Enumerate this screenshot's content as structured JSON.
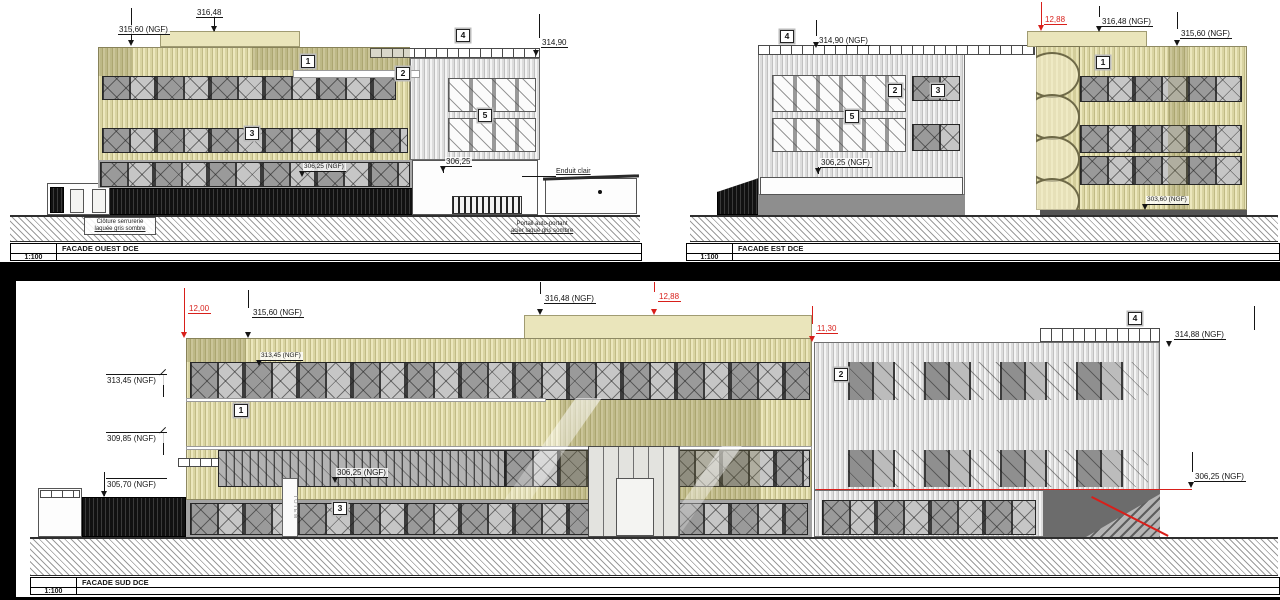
{
  "colors": {
    "accent_red": "#d81f1a",
    "facade_yellow": "#d9d4a2",
    "cladding_gray": "#dcdcdc"
  },
  "west": {
    "title": "FACADE OUEST DCE",
    "scale": "1:100",
    "tags": {
      "t1": "1",
      "t2": "2",
      "t3": "3",
      "t4": "4",
      "t5": "5"
    },
    "labels": {
      "e316_48": "316,48",
      "e315_60": "315,60 (NGF)",
      "e314_90": "314,90",
      "e306_25_ngf": "306,25 (NGF)",
      "e306_25": "306,25",
      "enduit": "Enduit clair",
      "cloture_1": "Clôture serrurerie",
      "cloture_2": "laquée gris sombre",
      "portail_1": "Portail auto-portant",
      "portail_2": "acier laqué gris sombre"
    }
  },
  "est": {
    "title": "FACADE EST DCE",
    "scale": "1:100",
    "tags": {
      "t1": "1",
      "t2": "2",
      "t3": "3",
      "t4": "4",
      "t5": "5"
    },
    "labels": {
      "red_12_88": "12,88",
      "e316_48": "316,48 (NGF)",
      "e315_60": "315,60 (NGF)",
      "e314_90": "314,90 (NGF)",
      "e306_25": "306,25 (NGF)",
      "e303_60": "303,60 (NGF)"
    }
  },
  "sud": {
    "title": "FACADE SUD DCE",
    "scale": "1:100",
    "tags": {
      "t1": "1",
      "t2": "2",
      "t3": "3",
      "t4": "4"
    },
    "labels": {
      "red_12_00": "12,00",
      "red_12_88": "12,88",
      "red_11_30": "11,30",
      "e315_60": "315,60 (NGF)",
      "e316_48": "316,48 (NGF)",
      "e314_88": "314,88 (NGF)",
      "e313_45_wall": "313,45 (NGF)",
      "e313_45": "313,45 (NGF)",
      "e309_85": "309,85 (NGF)",
      "e305_70": "305,70 (NGF)",
      "e306_25_mid": "306,25 (NGF)",
      "e306_25_right": "306,25 (NGF)",
      "totem": "TOTEM"
    }
  }
}
